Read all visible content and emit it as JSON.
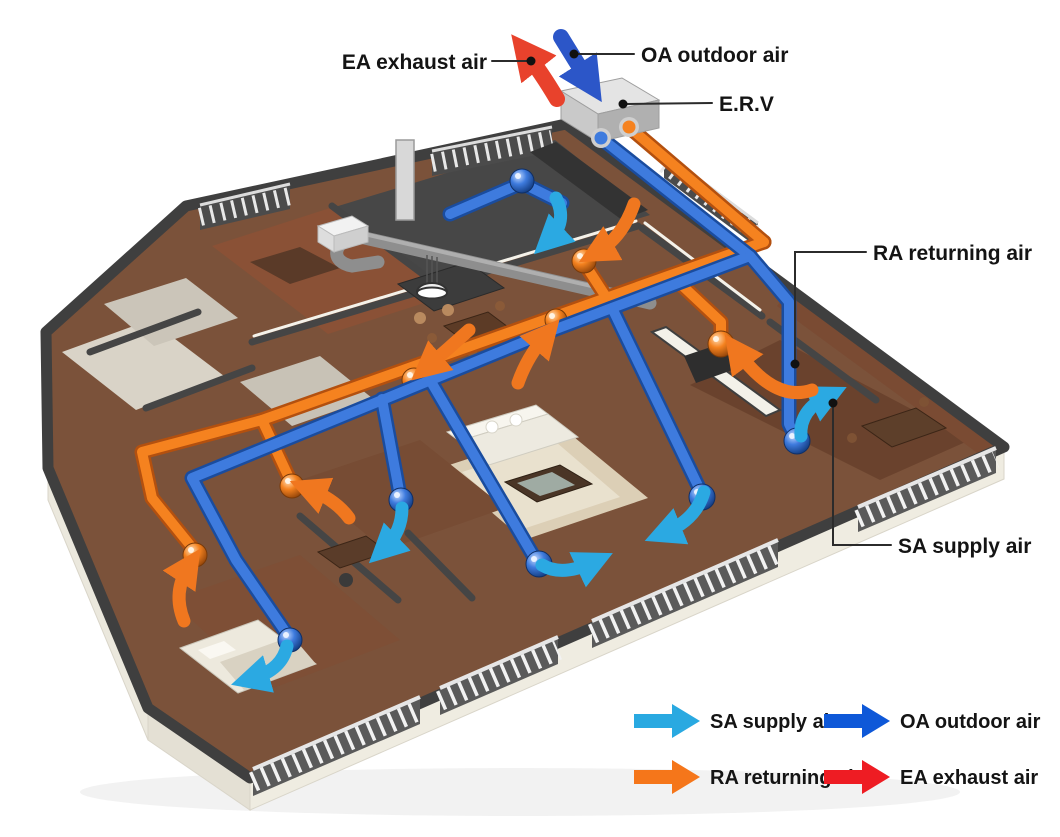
{
  "diagram": {
    "type": "isometric-erv-apartment-airflow",
    "annotations": {
      "ea": "EA exhaust air",
      "oa": "OA outdoor air",
      "erv": "E.R.V",
      "ra": "RA returning air",
      "sa": "SA supply air"
    },
    "legend": {
      "items": [
        {
          "id": "sa",
          "label": "SA supply air",
          "color": "#29A9E1",
          "icon": "arrow-right-icon"
        },
        {
          "id": "oa",
          "label": "OA outdoor air",
          "color": "#0E58D8",
          "icon": "arrow-right-icon"
        },
        {
          "id": "ra",
          "label": "RA returning air",
          "color": "#F5761A",
          "icon": "arrow-right-icon"
        },
        {
          "id": "ea",
          "label": "EA exhaust air",
          "color": "#EE1C23",
          "icon": "arrow-right-icon"
        }
      ]
    },
    "colors": {
      "supply_cyan": "#2BA9E2",
      "outdoor_blue": "#2C56C8",
      "return_orange": "#F0771F",
      "exhaust_red": "#E8422C",
      "duct_blue": "#3E7BDE",
      "duct_blue_dark": "#1A4C9E",
      "duct_orange": "#F5821F",
      "duct_orange_dark": "#B3500F",
      "wall_dark": "#3F3F3F",
      "floor_wood": "#7B523A"
    }
  }
}
